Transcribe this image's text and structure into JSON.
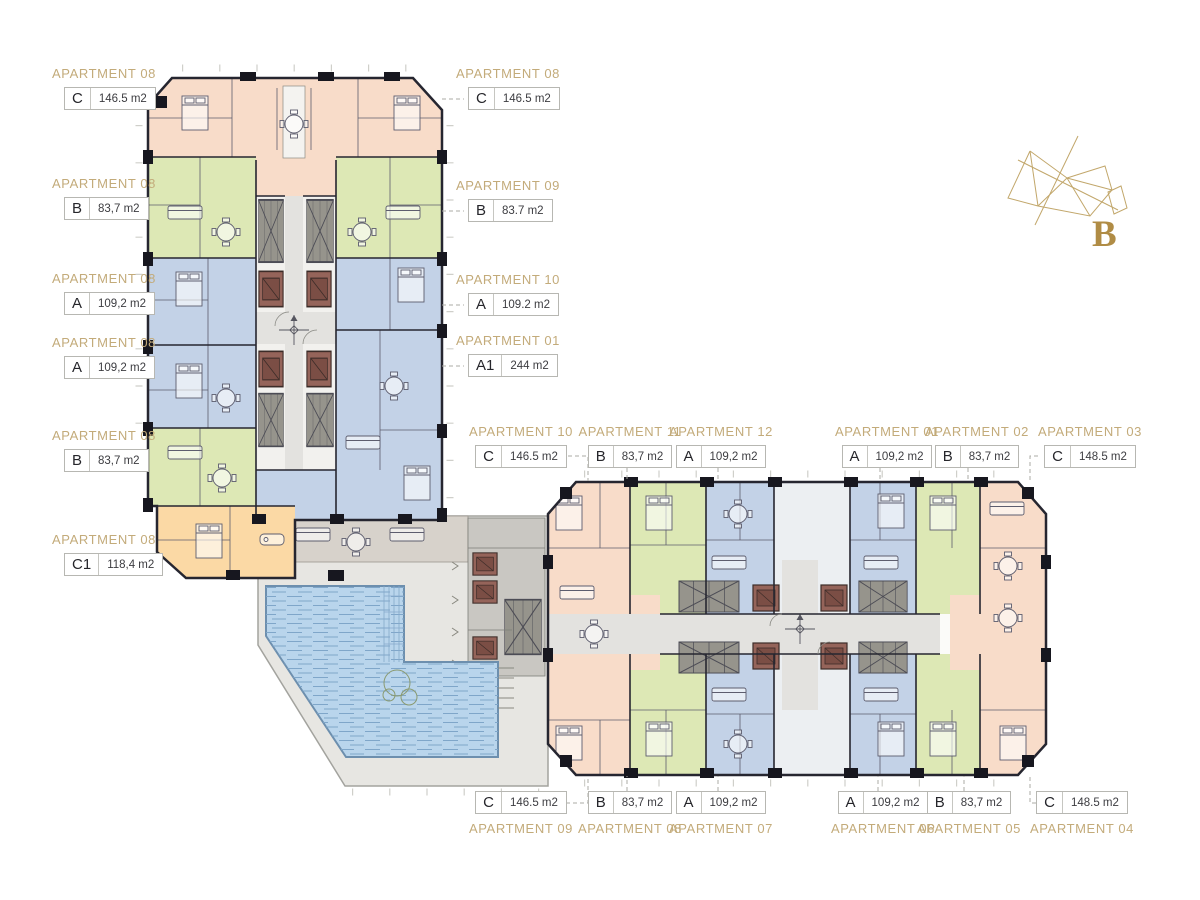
{
  "colors": {
    "wall": "#262630",
    "thin_line": "#5d5d6e",
    "unit_a": "#c3d2e7",
    "unit_b": "#dde8b5",
    "unit_c": "#f8dcc9",
    "unit_c1": "#fbd9a5",
    "core": "#96948c",
    "core_light": "#c9c7c2",
    "corridor": "#e3e2df",
    "elevator": "#95645a",
    "elevator_dark": "#7b4e45",
    "pool": "#b9d5ec",
    "pool_line": "#7fa6c9",
    "deck": "#e7e6e2",
    "deck_top": "#d7d2cb",
    "label_gold": "#c3ab7a",
    "logo_gold": "#b08c45",
    "logo_line": "#c2a76b"
  },
  "logo": {
    "letter": "B"
  },
  "labels": {
    "tower_left": [
      {
        "name": "APARTMENT 08",
        "type": "C",
        "area": "146.5 m2"
      },
      {
        "name": "APARTMENT 08",
        "type": "B",
        "area": "83,7 m2"
      },
      {
        "name": "APARTMENT 08",
        "type": "A",
        "area": "109,2 m2"
      },
      {
        "name": "APARTMENT 08",
        "type": "A",
        "area": "109,2 m2"
      },
      {
        "name": "APARTMENT 08",
        "type": "B",
        "area": "83,7 m2"
      },
      {
        "name": "APARTMENT 08",
        "type": "C1",
        "area": "118,4 m2"
      }
    ],
    "tower_right": [
      {
        "name": "APARTMENT 08",
        "type": "C",
        "area": "146.5 m2"
      },
      {
        "name": "APARTMENT 09",
        "type": "B",
        "area": "83.7 m2"
      },
      {
        "name": "APARTMENT 10",
        "type": "A",
        "area": "109.2 m2"
      },
      {
        "name": "APARTMENT 01",
        "type": "A1",
        "area": "244 m2"
      }
    ],
    "block_top": [
      {
        "name": "APARTMENT 10",
        "type": "C",
        "area": "146.5 m2"
      },
      {
        "name": "APARTMENT 11",
        "type": "B",
        "area": "83,7 m2"
      },
      {
        "name": "APARTMENT 12",
        "type": "A",
        "area": "109,2 m2"
      },
      {
        "name": "APARTMENT 01",
        "type": "A",
        "area": "109,2 m2"
      },
      {
        "name": "APARTMENT 02",
        "type": "B",
        "area": "83,7 m2"
      },
      {
        "name": "APARTMENT 03",
        "type": "C",
        "area": "148.5 m2"
      }
    ],
    "block_bottom": [
      {
        "name": "APARTMENT 09",
        "type": "C",
        "area": "146.5 m2"
      },
      {
        "name": "APARTMENT 08",
        "type": "B",
        "area": "83,7 m2"
      },
      {
        "name": "APARTMENT 07",
        "type": "A",
        "area": "109,2 m2"
      },
      {
        "name": "APARTMENT 06",
        "type": "A",
        "area": "109,2 m2"
      },
      {
        "name": "APARTMENT 05",
        "type": "B",
        "area": "83,7 m2"
      },
      {
        "name": "APARTMENT 04",
        "type": "C",
        "area": "148.5 m2"
      }
    ]
  }
}
